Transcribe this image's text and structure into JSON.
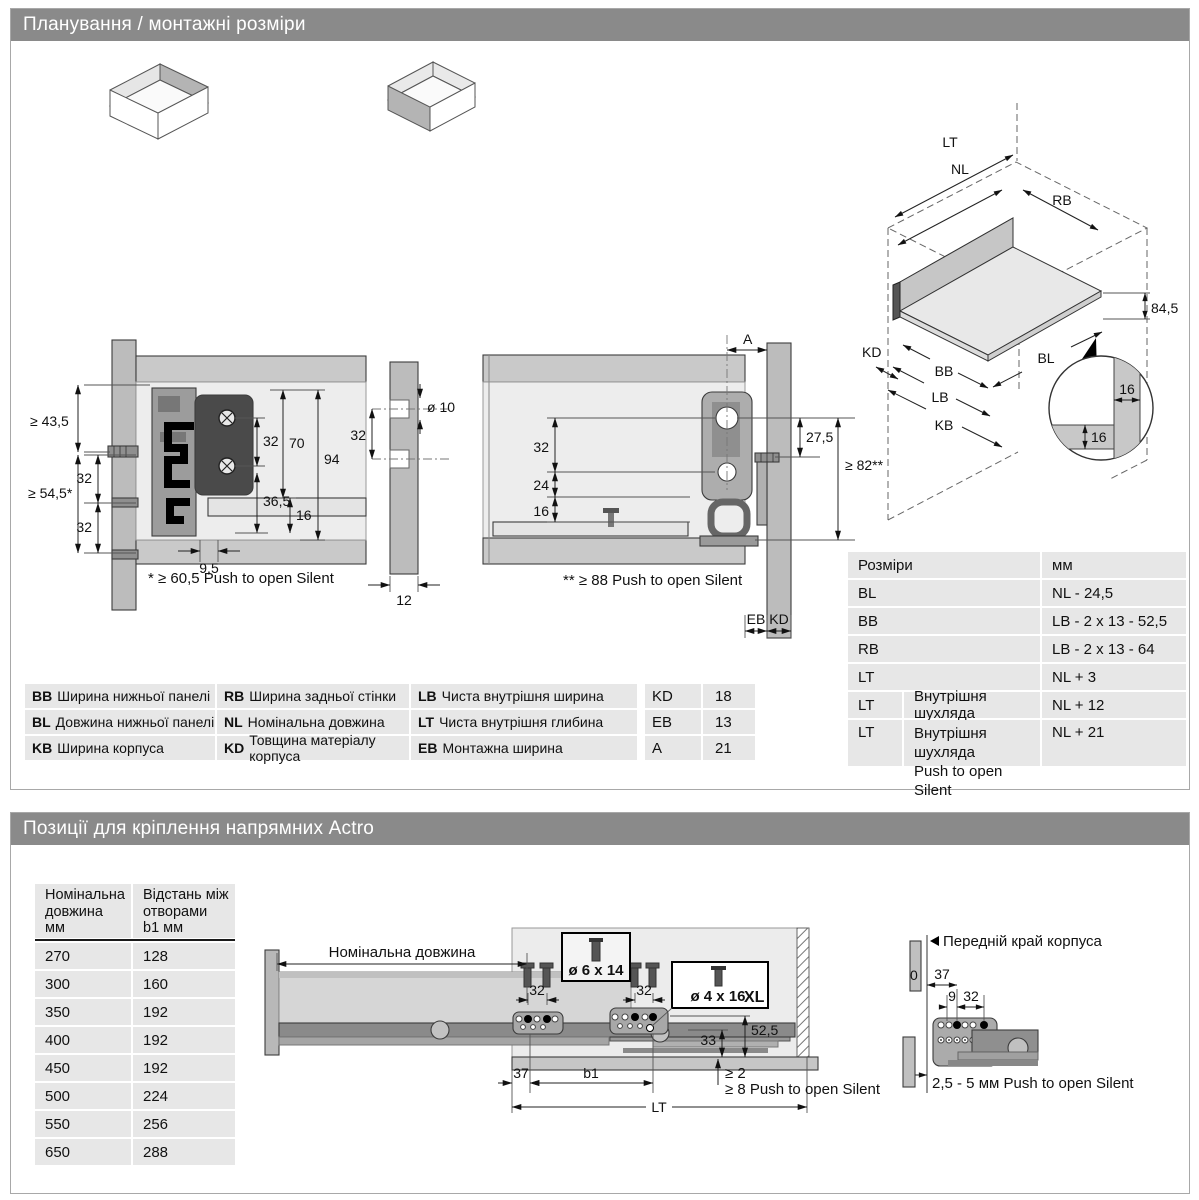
{
  "section1": {
    "title": "Планування / монтажні розміри",
    "left": {
      "d435": "≥ 43,5",
      "d545": "≥ 54,5*",
      "d32a": "32",
      "d32b": "32",
      "d32c": "32",
      "d70": "70",
      "d94": "94",
      "d365": "36,5",
      "d16": "16",
      "d95": "9,5",
      "note": "* ≥ 60,5 Push to open Silent",
      "d10": "ø 10",
      "d32p": "32",
      "d12": "12"
    },
    "middle": {
      "dA": "A",
      "d32": "32",
      "d24": "24",
      "d16": "16",
      "d275": "27,5",
      "d82": "≥ 82**",
      "note": "** ≥ 88 Push to open Silent",
      "eb": "EB",
      "kd": "KD"
    },
    "iso": {
      "lt": "LT",
      "nl": "NL",
      "rb": "RB",
      "d845": "84,5",
      "kd": "KD",
      "bb": "BB",
      "lb": "LB",
      "kb": "KB",
      "bl": "BL",
      "d16a": "16",
      "d16b": "16"
    },
    "legend": {
      "rows": [
        [
          {
            "code": "BB",
            "text": "Ширина нижньої панелі"
          },
          {
            "code": "RB",
            "text": "Ширина задньої стінки"
          },
          {
            "code": "LB",
            "text": "Чиста внутрішня ширина"
          }
        ],
        [
          {
            "code": "BL",
            "text": "Довжина нижньої панелі"
          },
          {
            "code": "NL",
            "text": "Номінальна довжина"
          },
          {
            "code": "LT",
            "text": "Чиста внутрішня глибина"
          }
        ],
        [
          {
            "code": "KB",
            "text": "Ширина корпуса"
          },
          {
            "code": "KD",
            "text": "Товщина матеріалу корпуса"
          },
          {
            "code": "EB",
            "text": "Монтажна ширина"
          }
        ]
      ]
    },
    "small_table": {
      "rows": [
        {
          "code": "KD",
          "value": "18"
        },
        {
          "code": "EB",
          "value": "13"
        },
        {
          "code": "A",
          "value": "21"
        }
      ]
    },
    "dim_table": {
      "header": {
        "c1": "Розміри",
        "c2": "мм"
      },
      "rows": [
        {
          "code": "BL",
          "value": "NL - 24,5"
        },
        {
          "code": "BB",
          "value": "LB - 2 x 13 - 52,5"
        },
        {
          "code": "RB",
          "value": "LB - 2 x 13 - 64"
        },
        {
          "code": "LT",
          "value": "NL + 3"
        },
        {
          "code": "LT",
          "desc": "Внутрішня шухляда",
          "value": "NL + 12"
        },
        {
          "code": "LT",
          "desc": "Внутрішня шухляда\nPush to open Silent",
          "value": "NL + 21"
        }
      ]
    }
  },
  "section2": {
    "title": "Позиції для кріплення напрямних Actro",
    "table": {
      "col1_header": "Номінальна\nдовжина\nмм",
      "col2_header": "Відстань між\nотворами\nb1 мм",
      "rows": [
        [
          "270",
          "128"
        ],
        [
          "300",
          "160"
        ],
        [
          "350",
          "192"
        ],
        [
          "400",
          "192"
        ],
        [
          "450",
          "192"
        ],
        [
          "500",
          "224"
        ],
        [
          "550",
          "256"
        ],
        [
          "650",
          "288"
        ]
      ]
    },
    "drawing": {
      "nominal": "Номінальна довжина",
      "screw_box1": "ø 6 x 14",
      "screw_box2": "ø 4 x 16",
      "screw_box2_xl": "XL",
      "d32a": "32",
      "d32b": "32",
      "d33": "33",
      "d525": "52,5",
      "d37": "37",
      "b1": "b1",
      "lt": "LT",
      "gap1": "≥ 2",
      "gap2": "≥ 8 Push to open Silent"
    },
    "right": {
      "label": "Передній край корпуса",
      "d0": "0",
      "d37": "37",
      "d9": "9",
      "d32": "32",
      "note": "2,5 - 5 мм Push to open Silent"
    }
  }
}
